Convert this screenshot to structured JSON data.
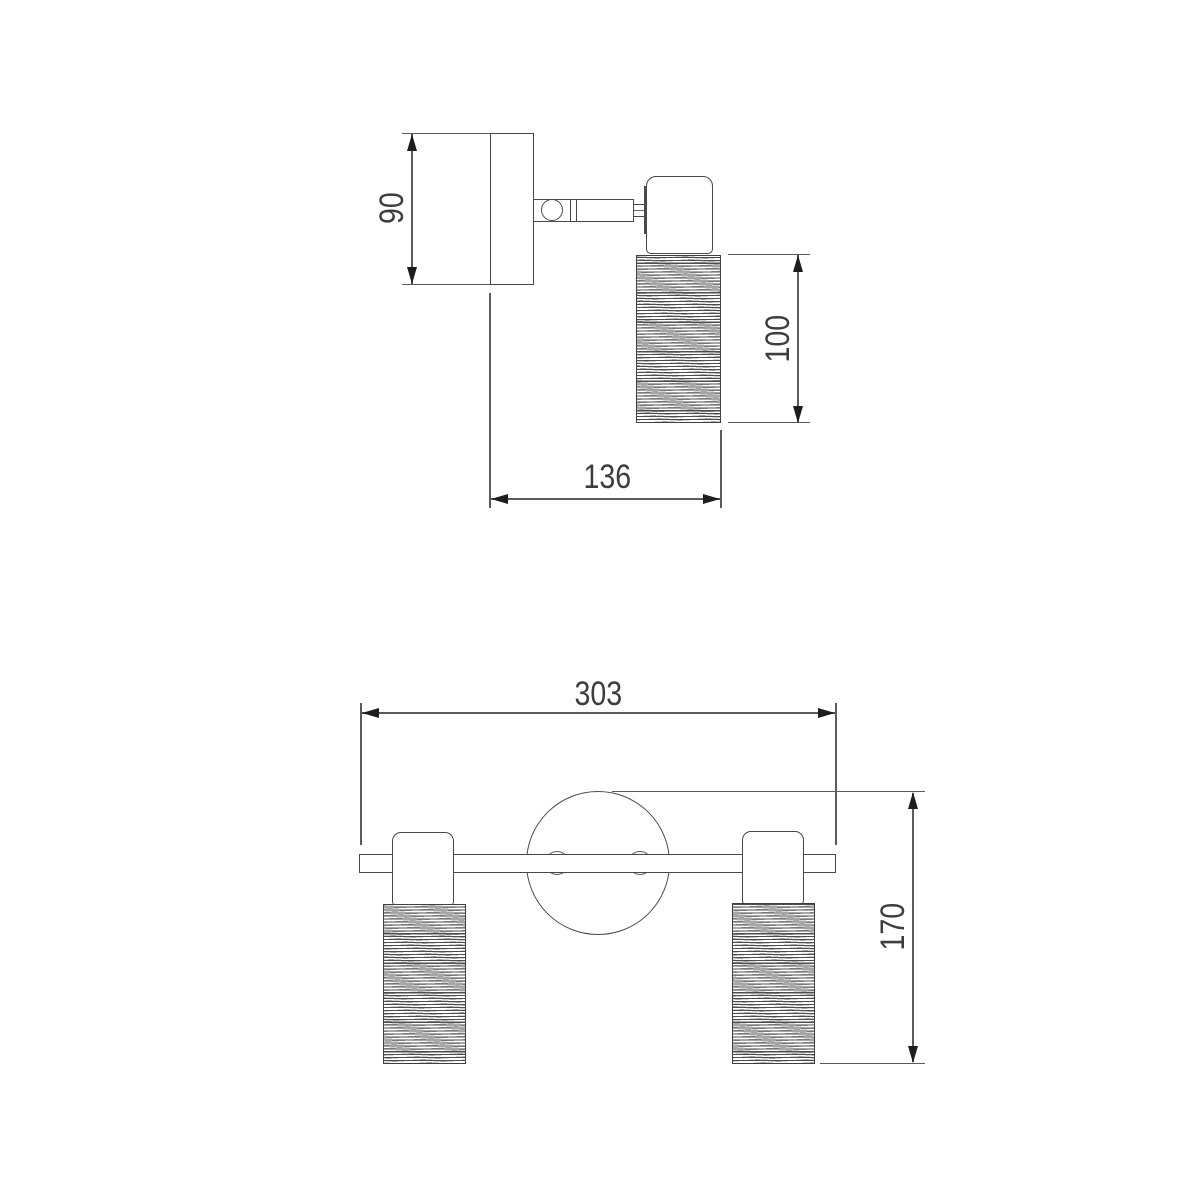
{
  "drawing": {
    "type": "technical-dimension-drawing",
    "subject": "two-spot wall lamp",
    "colors": {
      "background": "#ffffff",
      "outline": "#474747",
      "dimension_line": "#5a5a5a",
      "arrow": "#1d1d1d",
      "text": "#3d3d3d"
    },
    "views": {
      "side": {
        "dimensions": {
          "plate_height": {
            "label": "90"
          },
          "shade_length": {
            "label": "100"
          },
          "depth": {
            "label": "136"
          }
        }
      },
      "front": {
        "dimensions": {
          "overall_width": {
            "label": "303"
          },
          "overall_height": {
            "label": "170"
          }
        }
      }
    }
  }
}
